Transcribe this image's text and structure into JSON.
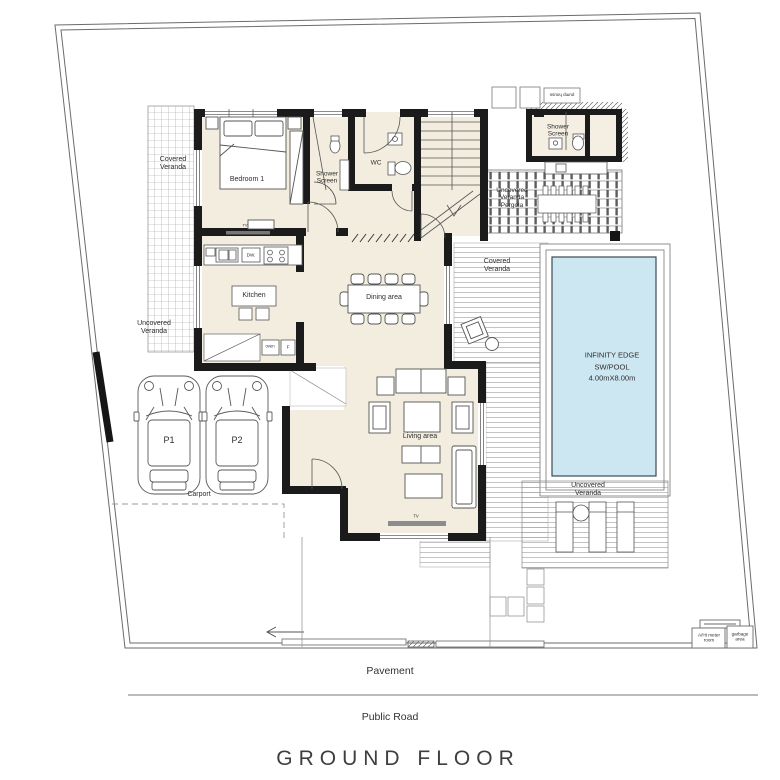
{
  "title": "GROUND FLOOR",
  "streets": {
    "pavement": "Pavement",
    "public_road": "Public Road"
  },
  "rooms": {
    "bedroom1": "Bedroom 1",
    "shower_screen": "Shower Screen",
    "wc": "WC",
    "kitchen": "Kitchen",
    "dining_area": "Dining area",
    "living_area": "Living area"
  },
  "pool_house": {
    "shower_screen": "Shower Screen",
    "pump_house": "pump house"
  },
  "outdoor": {
    "covered_veranda_left": "Covered Veranda",
    "uncovered_veranda_left": "Uncovered Veranda",
    "pergola": "Uncovered Veranda Pergola",
    "covered_veranda_pool": "Covered Veranda",
    "uncovered_veranda_pool": "Uncovered Veranda",
    "carport": "Carport",
    "parking_p1": "P1",
    "parking_p2": "P2"
  },
  "pool": {
    "name_line1": "INFINITY EDGE",
    "name_line2": "SW/POOL",
    "size_line": "4.00mX8.00m"
  },
  "annex": {
    "meter_room": "A/Ht meter room",
    "garbage_area": "garbage area"
  },
  "fixtures": {
    "dishwasher": "DW.",
    "oven": "oven",
    "fridge": "F",
    "tv_bedroom": "TV",
    "tv_living": "TV"
  },
  "colors": {
    "pool_water": "#cde7f2",
    "floor": "#f2edde",
    "wall": "#1b1b1b",
    "deck_line": "#aaaaaa"
  }
}
